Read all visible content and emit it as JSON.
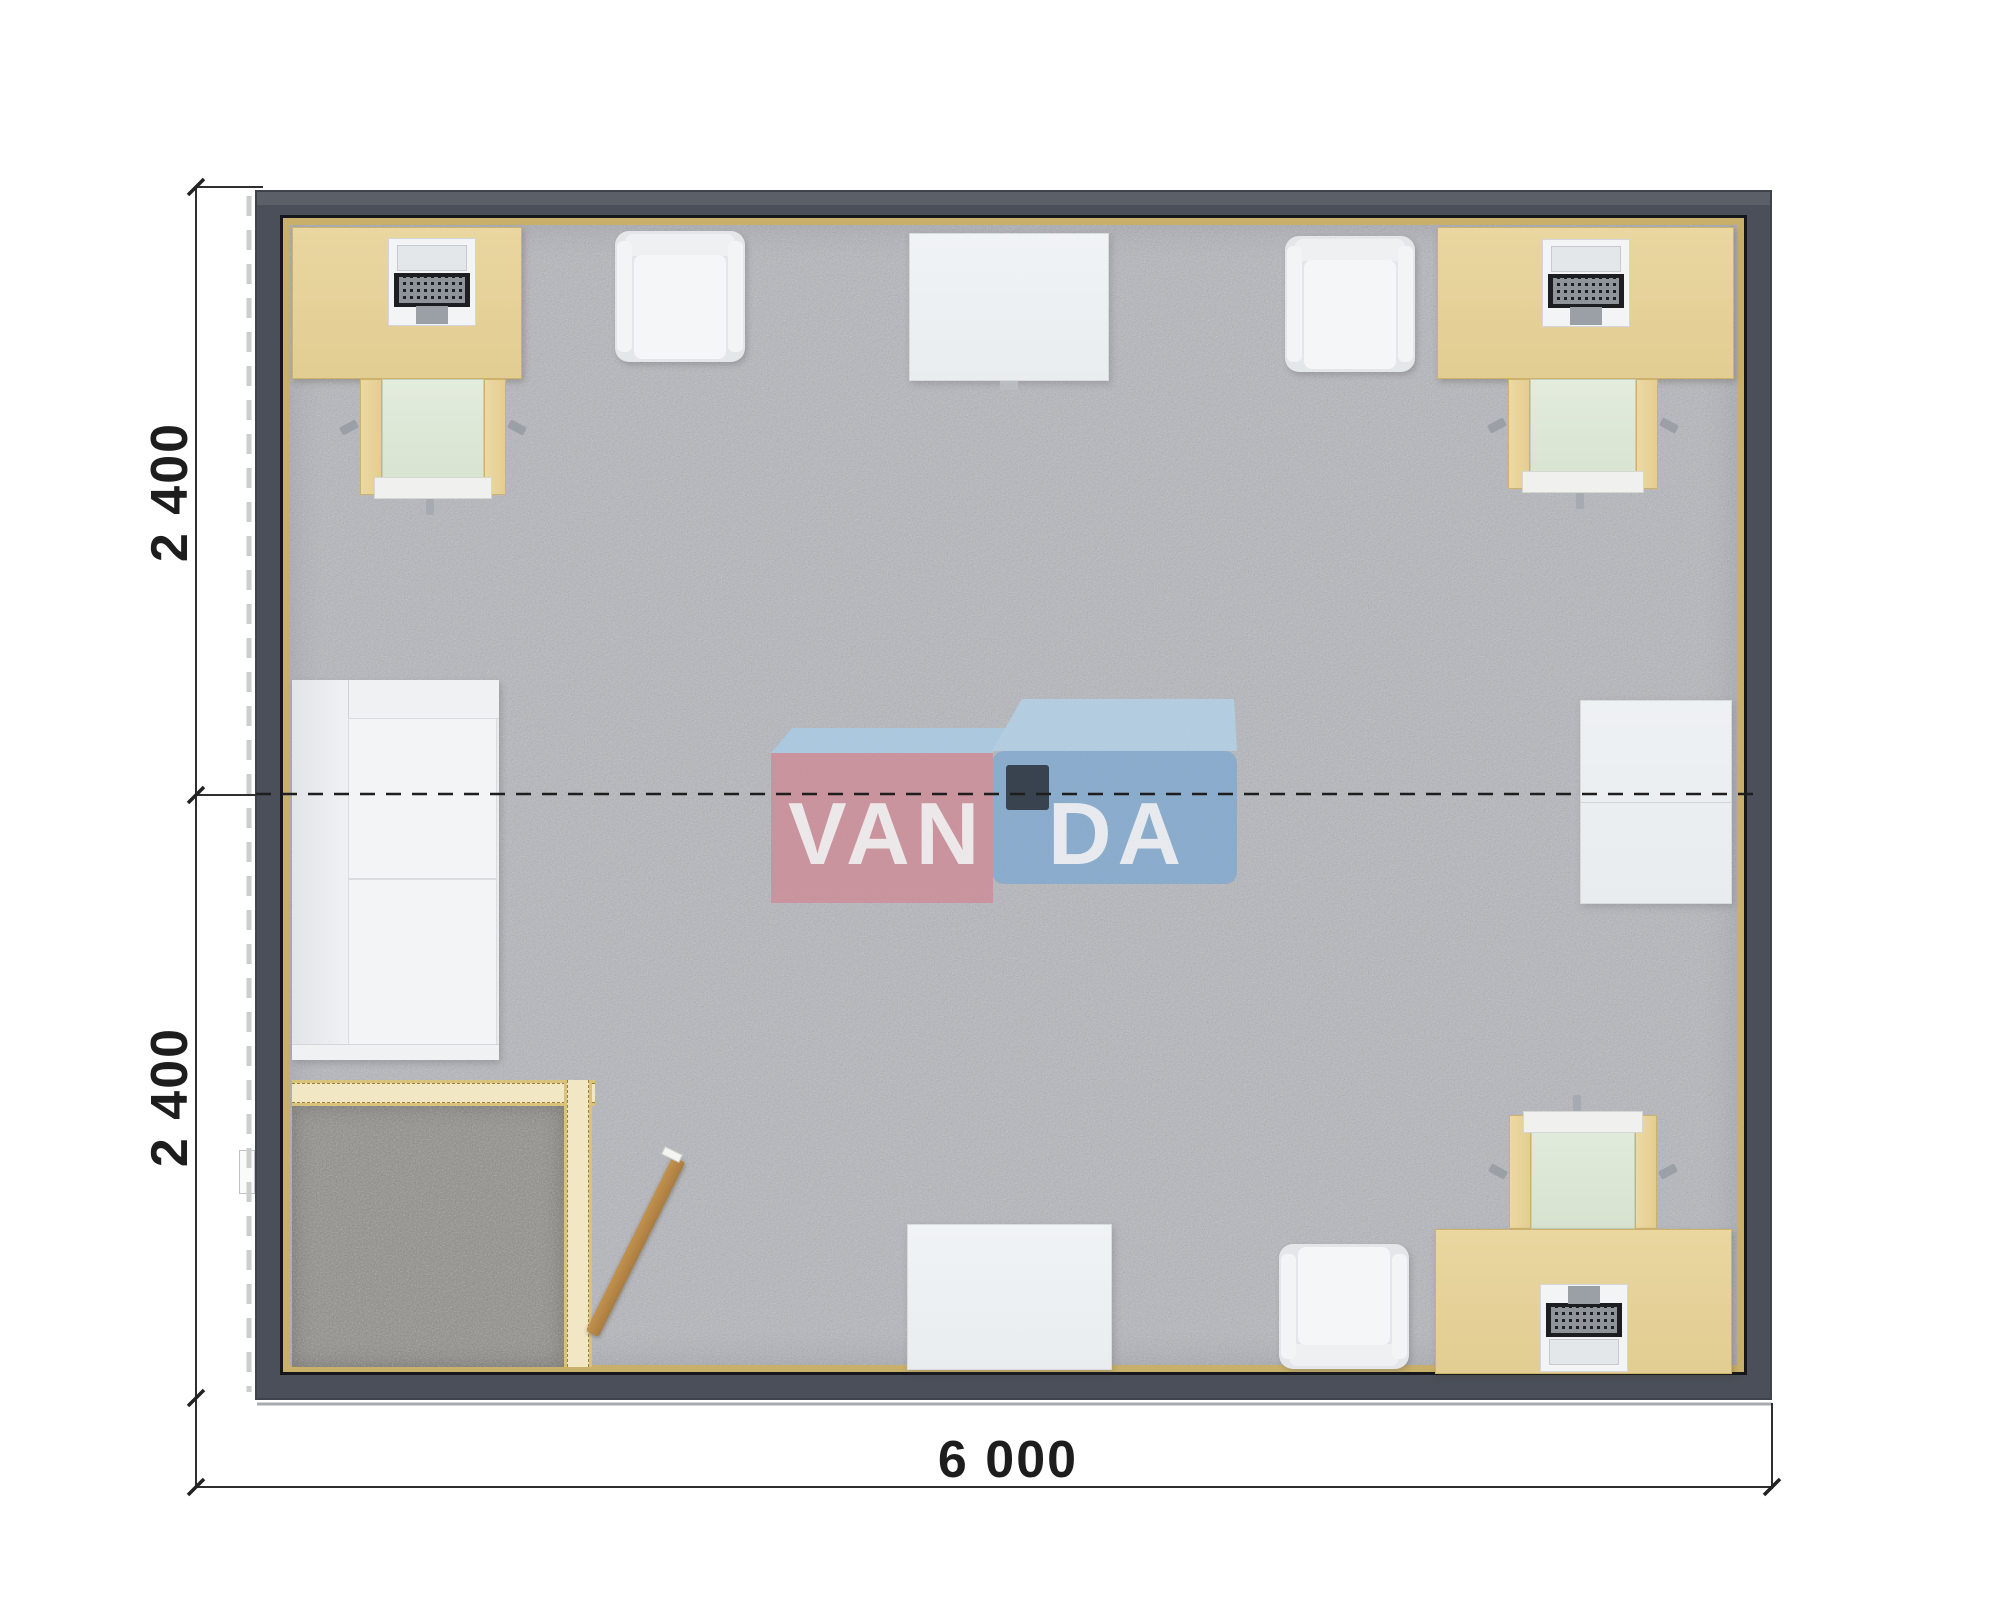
{
  "page": {
    "type": "modular office floor plan - top view render",
    "background": "#ffffff"
  },
  "dimensions": {
    "left_top": "2 400",
    "left_bottom": "2 400",
    "bottom": "6 000"
  },
  "watermark": {
    "text_left": "VAN",
    "text_right": "DA",
    "pink_box_color": "#d08a96",
    "blue_box_color": "#7fa9d0",
    "blue_top_color": "#a9cde7",
    "letter_color": "#ffffff"
  },
  "palette": {
    "wall": "#4a4f59",
    "carpet": "#b5b7bd",
    "vestibule_carpet": "#8f8d88",
    "desk": "#e4d099",
    "chair_seat": "#dde8d4",
    "partition": "#f2e7c4",
    "door_wood": "#b9854c",
    "furniture_white": "#f2f4f6",
    "dimension_line": "#2e2e2e"
  },
  "rooms": {
    "main": "open office",
    "entry": "vestibule"
  },
  "furniture_names": [
    "desk-top-left",
    "desk-top-right",
    "desk-bottom-right",
    "task-chair-top-left",
    "task-chair-top-right",
    "task-chair-bottom-right",
    "armchair-top-left",
    "armchair-top-right",
    "armchair-bottom",
    "table-top-center",
    "table-bottom-center",
    "cabinet-right",
    "sofa-left",
    "entry-door",
    "computer-1",
    "computer-2",
    "computer-3"
  ]
}
